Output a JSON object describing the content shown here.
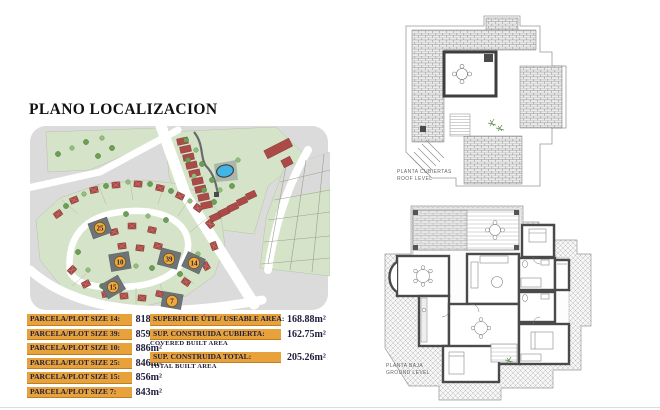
{
  "page": {
    "title": "PLANO LOCALIZACION"
  },
  "plot_table": {
    "rows": [
      {
        "label": "PARCELA/PLOT SIZE 14:",
        "value": "818m²"
      },
      {
        "label": "PARCELA/PLOT SIZE 39:",
        "value": "859m²"
      },
      {
        "label": "PARCELA/PLOT SIZE 10:",
        "value": "886m²"
      },
      {
        "label": "PARCELA/PLOT SIZE 25:",
        "value": "846m²"
      },
      {
        "label": "PARCELA/PLOT SIZE 15:",
        "value": "856m²"
      },
      {
        "label": "PARCELA/PLOT SIZE 7:",
        "value": "843m²"
      }
    ]
  },
  "area_table": {
    "rows": [
      {
        "label": "SUPERFICIE ÚTIL/ USEABLE AREA:",
        "sublabel": "",
        "value": "168.88m²"
      },
      {
        "label": "SUP. CONSTRUIDA CUBIERTA:",
        "sublabel": "COVERED BUILT AREA",
        "value": "162.75m²"
      },
      {
        "label": "SUP. CONSTRUIDA TOTAL:",
        "sublabel": "TOTAL BUILT AREA",
        "value": "205.26m²"
      }
    ]
  },
  "map": {
    "plots": [
      {
        "label": "25"
      },
      {
        "label": "10"
      },
      {
        "label": "39"
      },
      {
        "label": "14"
      },
      {
        "label": "15"
      },
      {
        "label": "7"
      }
    ]
  },
  "roof_plan": {
    "label_line1": "PLANTA CUBIERTAS",
    "label_line2": "ROOF LEVEL"
  },
  "ground_plan": {
    "label_line1": "PLANTA BAJA",
    "label_line2": "GROUND LEVEL"
  },
  "colors": {
    "accent_amber": "#E8A23C",
    "text_navy": "#20203E",
    "map_green": "#D5E3C8",
    "pool_blue": "#43B5E5",
    "house_red": "#AC4A47",
    "highlight_plot_gray": "#6E7375",
    "marker_orange": "#F2A93B"
  }
}
